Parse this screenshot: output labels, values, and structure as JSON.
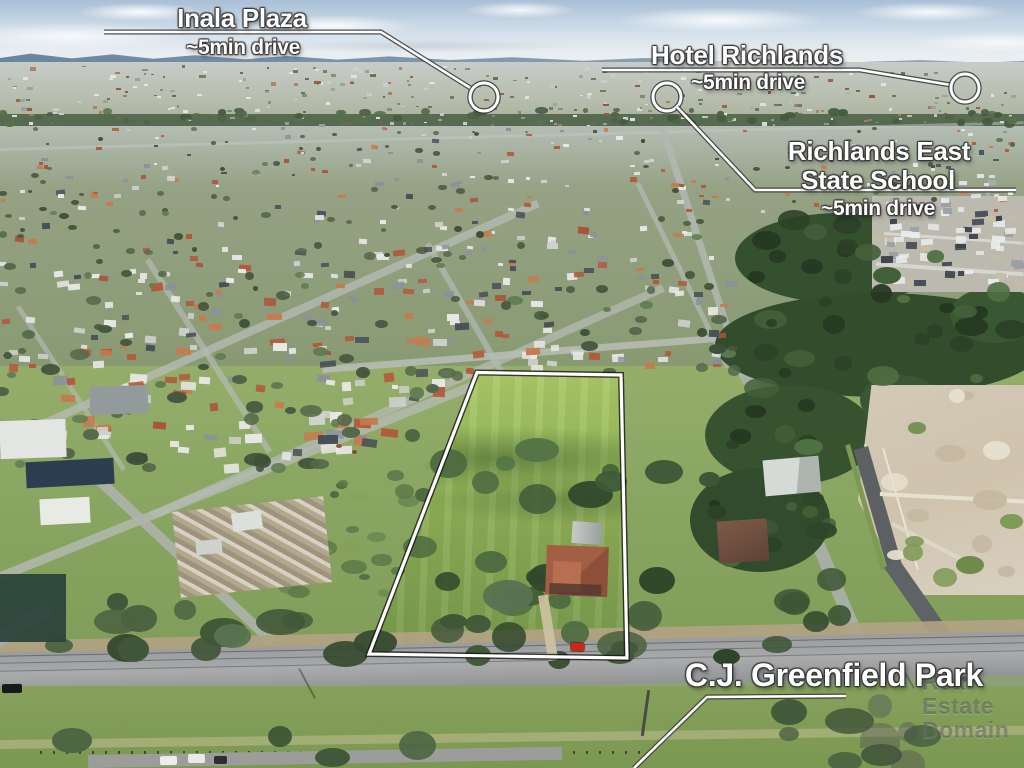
{
  "annotations": {
    "inala": {
      "title": "Inala Plaza",
      "drive_time": "~5min drive"
    },
    "hotel": {
      "title": "Hotel Richlands",
      "drive_time": "~5min drive"
    },
    "school": {
      "line1": "Richlands East",
      "line2": "State School",
      "drive_time": "~5min drive"
    },
    "park": {
      "title": "C.J. Greenfield Park"
    }
  },
  "watermark": {
    "line1": "Real",
    "line2": "Estate",
    "line3": "Domain"
  },
  "colors": {
    "annotation_text": "#ffffff",
    "leader_line": "#ffffff",
    "property_boundary": "#ffffff"
  }
}
